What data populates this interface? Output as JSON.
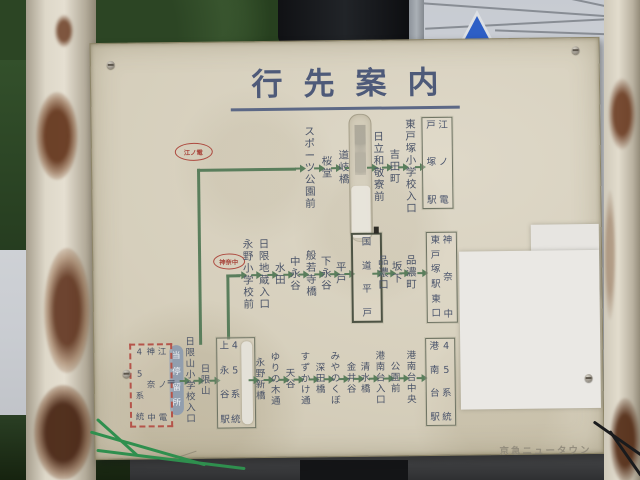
{
  "title": "行先案内",
  "corner_label": "京急ニュータウン",
  "colors": {
    "board": "#d6cfbc",
    "route_line_green": "#5a7e5c",
    "stop_text": "#4b5468",
    "operator_red": "#a8453b",
    "current_stop_fill": "#919eae",
    "legend_border": "#b5544a"
  },
  "legend": {
    "box": {
      "x": 35,
      "y": 300,
      "w": 37,
      "h": 74
    },
    "columns": [
      "45系統",
      "神奈中",
      "江ノ電"
    ],
    "equals": "＝",
    "equals_pos": {
      "x": 72,
      "y": 332
    }
  },
  "routes": [
    {
      "id": "totsuka",
      "badge": {
        "label": "江ノ電",
        "x": 101,
        "y": 108,
        "w": 36,
        "h": 16
      },
      "line_y": 127,
      "lines": [
        {
          "x": 105,
          "y": 126,
          "w": 99,
          "h": 3
        },
        {
          "x": 105,
          "y": 126,
          "w": 3,
          "h": 176
        }
      ],
      "start_x": 204,
      "stops": [
        {
          "x": 218,
          "label": "スポーツ公園前"
        },
        {
          "x": 235,
          "label": "桜堂"
        },
        {
          "x": 252,
          "label": "道岐橋"
        },
        {
          "type": "faded",
          "x": 257,
          "y": 73,
          "w": 21,
          "h": 126,
          "label": ""
        },
        {
          "x": 287,
          "label": "日立和敬寮前"
        },
        {
          "x": 303,
          "label": "吉田町"
        },
        {
          "x": 319,
          "label": "東戸塚小学校入口"
        },
        {
          "type": "box",
          "x": 330,
          "y": 77,
          "w": 27,
          "h": 84,
          "columns": [
            "戸塚駅",
            "江ノ電"
          ]
        }
      ]
    },
    {
      "id": "higashi-totsuka",
      "badge": {
        "label": "神奈中",
        "x": 135,
        "y": 218,
        "w": 30,
        "h": 14
      },
      "line_y": 233,
      "lines": [
        {
          "x": 133,
          "y": 232,
          "w": 14,
          "h": 3
        },
        {
          "x": 133,
          "y": 232,
          "w": 3,
          "h": 65
        }
      ],
      "start_x": 147,
      "stops": [
        {
          "x": 155,
          "label": "永野小学校前"
        },
        {
          "x": 171,
          "label": "日限地蔵入口"
        },
        {
          "x": 187,
          "label": "水田"
        },
        {
          "x": 202,
          "label": "中永谷"
        },
        {
          "x": 218,
          "label": "般若寺橋"
        },
        {
          "x": 233,
          "label": "下永谷"
        },
        {
          "x": 248,
          "label": "平戸"
        },
        {
          "type": "box",
          "x": 258,
          "y": 192,
          "w": 25,
          "h": 80,
          "columns": [
            "国道平戸"
          ],
          "thick": true
        },
        {
          "x": 290,
          "label": "品濃口"
        },
        {
          "x": 304,
          "label": "坂下"
        },
        {
          "x": 318,
          "label": "品濃町"
        },
        {
          "type": "box",
          "x": 333,
          "y": 192,
          "w": 27,
          "h": 83,
          "columns": [
            "東戸塚駅東口",
            "神奈中"
          ]
        }
      ]
    },
    {
      "id": "konandai",
      "line_y": 338,
      "lines": [],
      "start_x": null,
      "stops": [
        {
          "type": "capsule",
          "x": 75,
          "y": 302,
          "w": 14,
          "h": 70,
          "label": "当停留所"
        },
        {
          "x": 96,
          "label": "日限山小学校入口"
        },
        {
          "x": 111,
          "label": "日限山"
        },
        {
          "type": "box",
          "x": 122,
          "y": 295,
          "w": 35,
          "h": 83,
          "columns": [
            "上永谷駅",
            "45系統"
          ],
          "tape": true
        },
        {
          "x": 166,
          "label": "永野新橋"
        },
        {
          "x": 181,
          "label": "ゆりの木通"
        },
        {
          "x": 196,
          "label": "天谷"
        },
        {
          "x": 211,
          "label": "すずかけ通"
        },
        {
          "x": 226,
          "label": "深田橋"
        },
        {
          "x": 241,
          "label": "みやのくぼ"
        },
        {
          "x": 257,
          "label": "金井谷"
        },
        {
          "x": 271,
          "label": "清水橋"
        },
        {
          "x": 286,
          "label": "港南台入口"
        },
        {
          "x": 301,
          "label": "公園前"
        },
        {
          "x": 317,
          "label": "港南台中央"
        },
        {
          "type": "box",
          "x": 331,
          "y": 298,
          "w": 26,
          "h": 80,
          "columns": [
            "港南台駅",
            "45系統"
          ]
        }
      ]
    }
  ]
}
